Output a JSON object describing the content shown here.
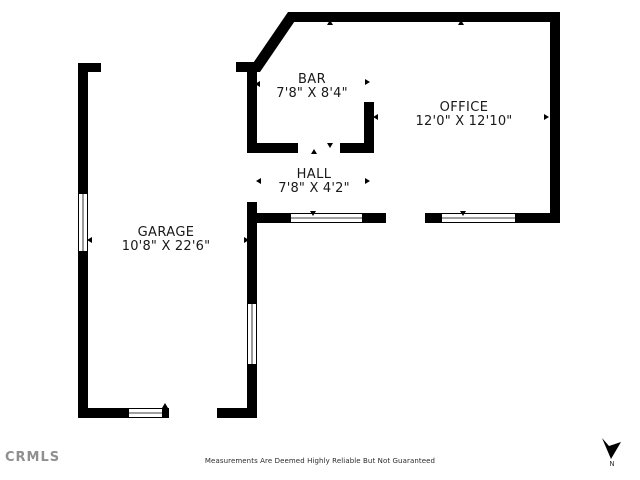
{
  "rooms": [
    {
      "name": "BAR",
      "dimensions": "7'8\" X 8'4\""
    },
    {
      "name": "OFFICE",
      "dimensions": "12'0\" X 12'10\""
    },
    {
      "name": "HALL",
      "dimensions": "7'8\" X 4'2\""
    },
    {
      "name": "GARAGE",
      "dimensions": "10'8\" X 22'6\""
    }
  ],
  "footer": {
    "logo_text": "CRMLS",
    "disclaimer": "Measurements Are Deemed Highly Reliable But Not Guaranteed"
  },
  "compass": {
    "label": "N",
    "icon": "north-arrow-icon",
    "direction": "down"
  },
  "colors": {
    "wall": "#000000",
    "label_text": "#191919",
    "logo_gray": "#8f8f8f",
    "background": "#ffffff"
  }
}
